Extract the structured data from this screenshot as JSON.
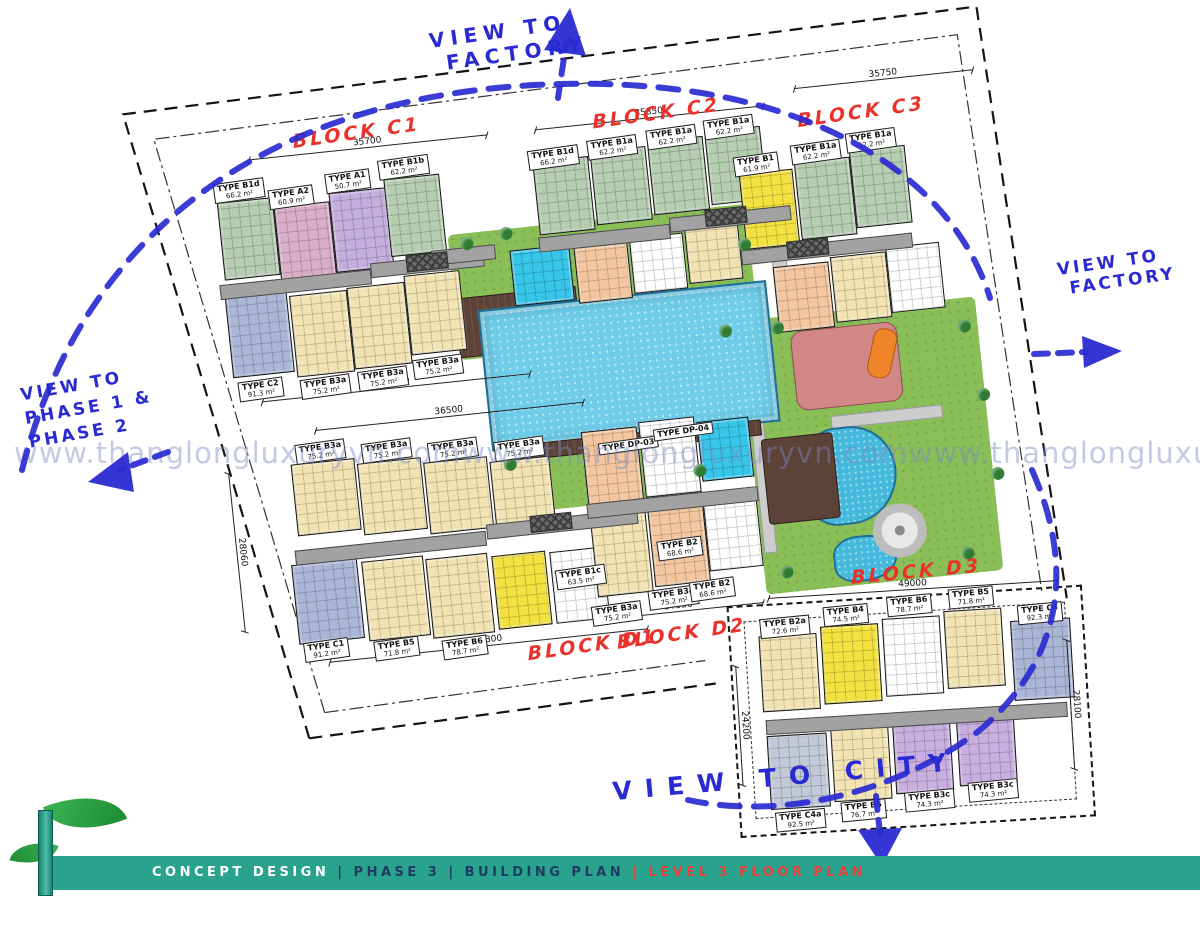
{
  "colors": {
    "green": "#b5cdb0",
    "mauve": "#d9aec9",
    "lavender": "#c3aedd",
    "cream": "#f2e3b3",
    "bluegray": "#aab6d6",
    "byellow": "#f2e13e",
    "peach": "#f3c6a0",
    "purple": "#c9aee0",
    "gray2": "#c2c8d8",
    "cyan": "#37c5ea",
    "pink": "#d28787",
    "orange": "#f08428",
    "kidpool": "#45b9dc",
    "brown": "#5d4237",
    "teal": "#2aa38e",
    "red": "#e8322b",
    "blue": "#2a2ad2",
    "poolblue": "#6fcde9",
    "lawn": "#8abf58",
    "path": "#cdcdcd"
  },
  "watermark": {
    "text": "www.thanglongluxuryvn.com"
  },
  "views": {
    "top_l1": "VIEW TO",
    "top_l2": "FACTORY",
    "right_l1": "VIEW TO",
    "right_l2": "FACTORY",
    "left_l1": "VIEW TO",
    "left_l2": "PHASE 1 &",
    "left_l3": "PHASE 2",
    "bottom": "VIEW TO CITY"
  },
  "boundary": {
    "boundary_line_label": "RANH ĐẤT / BOUNDARY LINE",
    "setback_line_label": "KHOẢNG LÙI 6000MM / 6000MM SETBACK LINE"
  },
  "blocks": [
    {
      "name": "BLOCK C1",
      "units": [
        {
          "t": "TYPE B1d",
          "a": "66.2 m²",
          "x": 112,
          "y": 138
        },
        {
          "t": "TYPE A2",
          "a": "60.9 m²",
          "x": 166,
          "y": 150
        },
        {
          "t": "TYPE A1",
          "a": "50.7 m²",
          "x": 224,
          "y": 140
        },
        {
          "t": "TYPE B1b",
          "a": "62.2 m²",
          "x": 278,
          "y": 132
        },
        {
          "t": "TYPE C2",
          "a": "91.3 m²",
          "x": 116,
          "y": 338
        },
        {
          "t": "TYPE B3a",
          "a": "75.2 m²",
          "x": 178,
          "y": 342
        },
        {
          "t": "TYPE B3a",
          "a": "75.2 m²",
          "x": 236,
          "y": 340
        },
        {
          "t": "TYPE B3a",
          "a": "75.2 m²",
          "x": 292,
          "y": 334
        }
      ]
    },
    {
      "name": "BLOCK C2",
      "units": [
        {
          "t": "TYPE B1d",
          "a": "66.2 m²",
          "x": 428,
          "y": 138
        },
        {
          "t": "TYPE B1a",
          "a": "62.2 m²",
          "x": 488,
          "y": 134
        },
        {
          "t": "TYPE B1a",
          "a": "62.2 m²",
          "x": 548,
          "y": 130
        },
        {
          "t": "TYPE B1a",
          "a": "62.2 m²",
          "x": 606,
          "y": 126
        }
      ]
    },
    {
      "name": "BLOCK C3",
      "units": [
        {
          "t": "TYPE B1",
          "a": "61.9 m²",
          "x": 632,
          "y": 166
        },
        {
          "t": "TYPE B1a",
          "a": "62.2 m²",
          "x": 690,
          "y": 160
        },
        {
          "t": "TYPE B1a",
          "a": "62.2 m²",
          "x": 746,
          "y": 154
        }
      ]
    },
    {
      "name": "BLOCK D1",
      "units": [
        {
          "t": "TYPE B3a",
          "a": "75.2 m²",
          "x": 166,
          "y": 406
        },
        {
          "t": "TYPE B3a",
          "a": "75.2 m²",
          "x": 232,
          "y": 412
        },
        {
          "t": "TYPE B3a",
          "a": "75.2 m²",
          "x": 298,
          "y": 418
        },
        {
          "t": "TYPE B3a",
          "a": "75.2 m²",
          "x": 364,
          "y": 424
        },
        {
          "t": "TYPE DP-03",
          "a": "",
          "x": 468,
          "y": 436
        },
        {
          "t": "TYPE DP-04",
          "a": "",
          "x": 524,
          "y": 428
        },
        {
          "t": "TYPE C1",
          "a": "91.2 m²",
          "x": 154,
          "y": 604
        },
        {
          "t": "TYPE B5",
          "a": "71.8 m²",
          "x": 224,
          "y": 610
        },
        {
          "t": "TYPE B6",
          "a": "78.7 m²",
          "x": 292,
          "y": 616
        },
        {
          "t": "TYPE B1c",
          "a": "63.5 m²",
          "x": 412,
          "y": 558
        }
      ]
    },
    {
      "name": "BLOCK D2",
      "units": [
        {
          "t": "TYPE B3a",
          "a": "75.2 m²",
          "x": 444,
          "y": 598
        },
        {
          "t": "TYPE B3a",
          "a": "75.2 m²",
          "x": 502,
          "y": 588
        },
        {
          "t": "TYPE B2",
          "a": "68.6 m²",
          "x": 516,
          "y": 540
        },
        {
          "t": "TYPE B2",
          "a": "68.6 m²",
          "x": 544,
          "y": 584
        }
      ]
    },
    {
      "name": "BLOCK D3",
      "units": [
        {
          "t": "TYPE B2a",
          "a": "72.6 m²",
          "x": 46,
          "y": 42
        },
        {
          "t": "TYPE B4",
          "a": "74.5 m²",
          "x": 110,
          "y": 34
        },
        {
          "t": "TYPE B6",
          "a": "78.7 m²",
          "x": 174,
          "y": 28
        },
        {
          "t": "TYPE B5",
          "a": "71.8 m²",
          "x": 236,
          "y": 24
        },
        {
          "t": "TYPE C4",
          "a": "92.3 m²",
          "x": 304,
          "y": 44
        },
        {
          "t": "TYPE C4a",
          "a": "92.5 m²",
          "x": 50,
          "y": 236
        },
        {
          "t": "TYPE B5",
          "a": "76.7 m²",
          "x": 116,
          "y": 230
        },
        {
          "t": "TYPE B3c",
          "a": "74.3 m²",
          "x": 180,
          "y": 224
        },
        {
          "t": "TYPE B3c",
          "a": "74.3 m²",
          "x": 244,
          "y": 218
        }
      ]
    }
  ],
  "dims": [
    {
      "v": "35700",
      "x": 150,
      "y": 118,
      "w": 240
    },
    {
      "v": "39350",
      "x": 138,
      "y": 360,
      "w": 270
    },
    {
      "v": "35850",
      "x": 438,
      "y": 118,
      "w": 230
    },
    {
      "v": "35750",
      "x": 700,
      "y": 104,
      "w": 180
    },
    {
      "v": "36500",
      "x": 188,
      "y": 394,
      "w": 270
    },
    {
      "v": "39300",
      "x": 178,
      "y": 626,
      "w": 320
    },
    {
      "v": "28060",
      "x": 98,
      "y": 428,
      "w": 160,
      "rot": 90
    },
    {
      "v": "37550",
      "x": 446,
      "y": 612,
      "w": 170
    }
  ],
  "d3_dims": [
    {
      "v": "49000",
      "x": 56,
      "y": 22,
      "w": 290
    },
    {
      "v": "24200",
      "x": 20,
      "y": 88,
      "w": 120,
      "rot": 90
    },
    {
      "v": "28100",
      "x": 352,
      "y": 82,
      "w": 130,
      "rot": 90
    }
  ],
  "plan_geometry": {
    "buildings": [
      {
        "x": 114,
        "y": 158,
        "w": 54,
        "h": 76,
        "c": "green"
      },
      {
        "x": 170,
        "y": 168,
        "w": 54,
        "h": 76,
        "c": "mauve"
      },
      {
        "x": 226,
        "y": 160,
        "w": 56,
        "h": 78,
        "c": "lavender"
      },
      {
        "x": 282,
        "y": 152,
        "w": 54,
        "h": 76,
        "c": "green"
      },
      {
        "x": 112,
        "y": 252,
        "w": 60,
        "h": 80,
        "c": "bluegray"
      },
      {
        "x": 176,
        "y": 258,
        "w": 56,
        "h": 80,
        "c": "cream"
      },
      {
        "x": 234,
        "y": 256,
        "w": 56,
        "h": 80,
        "c": "cream"
      },
      {
        "x": 292,
        "y": 250,
        "w": 54,
        "h": 78,
        "c": "cream"
      },
      {
        "x": 432,
        "y": 150,
        "w": 54,
        "h": 72,
        "c": "green"
      },
      {
        "x": 490,
        "y": 146,
        "w": 54,
        "h": 72,
        "c": "green"
      },
      {
        "x": 548,
        "y": 142,
        "w": 54,
        "h": 72,
        "c": "green"
      },
      {
        "x": 606,
        "y": 138,
        "w": 54,
        "h": 72,
        "c": "green"
      },
      {
        "x": 400,
        "y": 236,
        "w": 58,
        "h": 54,
        "c": "cyan"
      },
      {
        "x": 464,
        "y": 240,
        "w": 52,
        "h": 54,
        "c": "peach"
      },
      {
        "x": 520,
        "y": 236,
        "w": 52,
        "h": 54,
        "c": "white"
      },
      {
        "x": 576,
        "y": 232,
        "w": 52,
        "h": 54,
        "c": "cream"
      },
      {
        "x": 636,
        "y": 184,
        "w": 52,
        "h": 74,
        "c": "byellow"
      },
      {
        "x": 692,
        "y": 178,
        "w": 54,
        "h": 76,
        "c": "green"
      },
      {
        "x": 748,
        "y": 172,
        "w": 54,
        "h": 76,
        "c": "green"
      },
      {
        "x": 660,
        "y": 280,
        "w": 54,
        "h": 64,
        "c": "peach"
      },
      {
        "x": 718,
        "y": 276,
        "w": 54,
        "h": 64,
        "c": "cream"
      },
      {
        "x": 774,
        "y": 272,
        "w": 52,
        "h": 64,
        "c": "white"
      },
      {
        "x": 160,
        "y": 426,
        "w": 62,
        "h": 70,
        "c": "cream"
      },
      {
        "x": 226,
        "y": 432,
        "w": 62,
        "h": 70,
        "c": "cream"
      },
      {
        "x": 292,
        "y": 438,
        "w": 62,
        "h": 70,
        "c": "cream"
      },
      {
        "x": 358,
        "y": 444,
        "w": 58,
        "h": 68,
        "c": "cream"
      },
      {
        "x": 150,
        "y": 526,
        "w": 64,
        "h": 78,
        "c": "bluegray"
      },
      {
        "x": 220,
        "y": 530,
        "w": 60,
        "h": 78,
        "c": "cream"
      },
      {
        "x": 284,
        "y": 534,
        "w": 60,
        "h": 78,
        "c": "cream"
      },
      {
        "x": 350,
        "y": 538,
        "w": 52,
        "h": 72,
        "c": "byellow"
      },
      {
        "x": 408,
        "y": 540,
        "w": 52,
        "h": 70,
        "c": "white"
      },
      {
        "x": 452,
        "y": 424,
        "w": 54,
        "h": 74,
        "c": "peach"
      },
      {
        "x": 510,
        "y": 420,
        "w": 54,
        "h": 74,
        "c": "white"
      },
      {
        "x": 568,
        "y": 426,
        "w": 50,
        "h": 58,
        "c": "cyan"
      },
      {
        "x": 452,
        "y": 510,
        "w": 54,
        "h": 78,
        "c": "cream"
      },
      {
        "x": 510,
        "y": 506,
        "w": 54,
        "h": 78,
        "c": "peach"
      },
      {
        "x": 566,
        "y": 500,
        "w": 52,
        "h": 74,
        "c": "white"
      }
    ],
    "d3_buildings": [
      {
        "x": 44,
        "y": 60,
        "w": 56,
        "h": 74,
        "c": "cream"
      },
      {
        "x": 106,
        "y": 54,
        "w": 56,
        "h": 76,
        "c": "byellow"
      },
      {
        "x": 168,
        "y": 50,
        "w": 56,
        "h": 76,
        "c": "white"
      },
      {
        "x": 230,
        "y": 46,
        "w": 56,
        "h": 76,
        "c": "cream"
      },
      {
        "x": 296,
        "y": 60,
        "w": 58,
        "h": 78,
        "c": "bluegray"
      },
      {
        "x": 46,
        "y": 160,
        "w": 58,
        "h": 72,
        "c": "gray2"
      },
      {
        "x": 110,
        "y": 156,
        "w": 56,
        "h": 72,
        "c": "cream"
      },
      {
        "x": 172,
        "y": 152,
        "w": 56,
        "h": 72,
        "c": "purple"
      },
      {
        "x": 236,
        "y": 148,
        "w": 56,
        "h": 72,
        "c": "purple"
      }
    ],
    "corridors": [
      {
        "x": 108,
        "y": 240,
        "w": 150,
        "label": "CORRIDOR"
      },
      {
        "x": 260,
        "y": 234,
        "w": 112,
        "label": "LIFT LOBBY"
      },
      {
        "x": 430,
        "y": 226,
        "w": 130,
        "label": "CORRIDOR"
      },
      {
        "x": 562,
        "y": 220,
        "w": 120,
        "label": "LIFT LOBBY"
      },
      {
        "x": 630,
        "y": 260,
        "w": 170,
        "label": "LIFT LOBBY"
      },
      {
        "x": 322,
        "y": 228,
        "w": 62,
        "label": "LINK BRIDGE"
      },
      {
        "x": 155,
        "y": 512,
        "w": 190,
        "label": "CORRIDOR"
      },
      {
        "x": 348,
        "y": 506,
        "w": 150,
        "label": "LIFT LOBBY"
      },
      {
        "x": 450,
        "y": 496,
        "w": 170,
        "label": "CORRIDOR"
      }
    ],
    "d3_corridors": [
      {
        "x": 46,
        "y": 144,
        "w": 300,
        "label": "LIFT LOBBY"
      }
    ],
    "lifts": [
      {
        "x": 296,
        "y": 230
      },
      {
        "x": 598,
        "y": 216
      },
      {
        "x": 676,
        "y": 256
      },
      {
        "x": 392,
        "y": 502
      }
    ],
    "greens": [
      {
        "x": 340,
        "y": 214,
        "w": 300,
        "h": 126
      },
      {
        "x": 620,
        "y": 330,
        "w": 238,
        "h": 275
      },
      {
        "x": 366,
        "y": 436,
        "w": 200,
        "h": 62
      },
      {
        "x": 424,
        "y": 414,
        "w": 26,
        "h": 84
      }
    ],
    "paths": [
      {
        "x": 660,
        "y": 242,
        "w": 13,
        "h": 94
      },
      {
        "x": 622,
        "y": 352,
        "w": 11,
        "h": 210
      },
      {
        "x": 702,
        "y": 434,
        "w": 110,
        "h": 11
      }
    ],
    "trees": [
      {
        "x": 352,
        "y": 218
      },
      {
        "x": 392,
        "y": 212
      },
      {
        "x": 628,
        "y": 248
      },
      {
        "x": 652,
        "y": 334
      },
      {
        "x": 838,
        "y": 352
      },
      {
        "x": 850,
        "y": 422
      },
      {
        "x": 856,
        "y": 502
      },
      {
        "x": 818,
        "y": 578
      },
      {
        "x": 636,
        "y": 578
      },
      {
        "x": 372,
        "y": 442
      },
      {
        "x": 560,
        "y": 468
      },
      {
        "x": 600,
        "y": 332
      }
    ],
    "boundary_texts": [
      {
        "text": "RANH ĐẤT / BOUNDARY LINE",
        "x": 8,
        "y": 212,
        "rot": 79
      },
      {
        "text": "KHOẢNG LÙI 6000MM / 6000MM SETBACK LINE",
        "x": 42,
        "y": 222,
        "rot": 79
      },
      {
        "text": "RANH ĐẤT / BOUNDARY LINE",
        "x": 60,
        "y": 40,
        "rot": -3
      },
      {
        "text": "KHOẢNG LÙI 6000MM / 6000MM SETBACK LINE",
        "x": 200,
        "y": 654,
        "rot": 4
      },
      {
        "text": "RANH ĐẤT / BOUNDARY LINE",
        "x": 168,
        "y": 688,
        "rot": 4
      },
      {
        "text": "KHOẢNG LÙI 6000MM / 6000MM SETBACK LINE",
        "x": 884,
        "y": 118,
        "rot": 84
      },
      {
        "text": "RANH ĐẤT / BOUNDARY LINE",
        "x": 908,
        "y": 46,
        "rot": 62
      }
    ],
    "d3_texts": [
      {
        "text": "KHOẢNG LÙI 6000MM / 6000MM SETBACK LINE",
        "x": 58,
        "y": 260,
        "rot": 2
      },
      {
        "text": "RANH ĐẤT / BOUNDARY LINE",
        "x": 36,
        "y": 282,
        "rot": 2
      }
    ]
  },
  "footer": {
    "left": "CONCEPT DESIGN",
    "middle": " | PHASE 3 | BUILDING PLAN ",
    "right": "| LEVEL 3 FLOOR PLAN"
  }
}
